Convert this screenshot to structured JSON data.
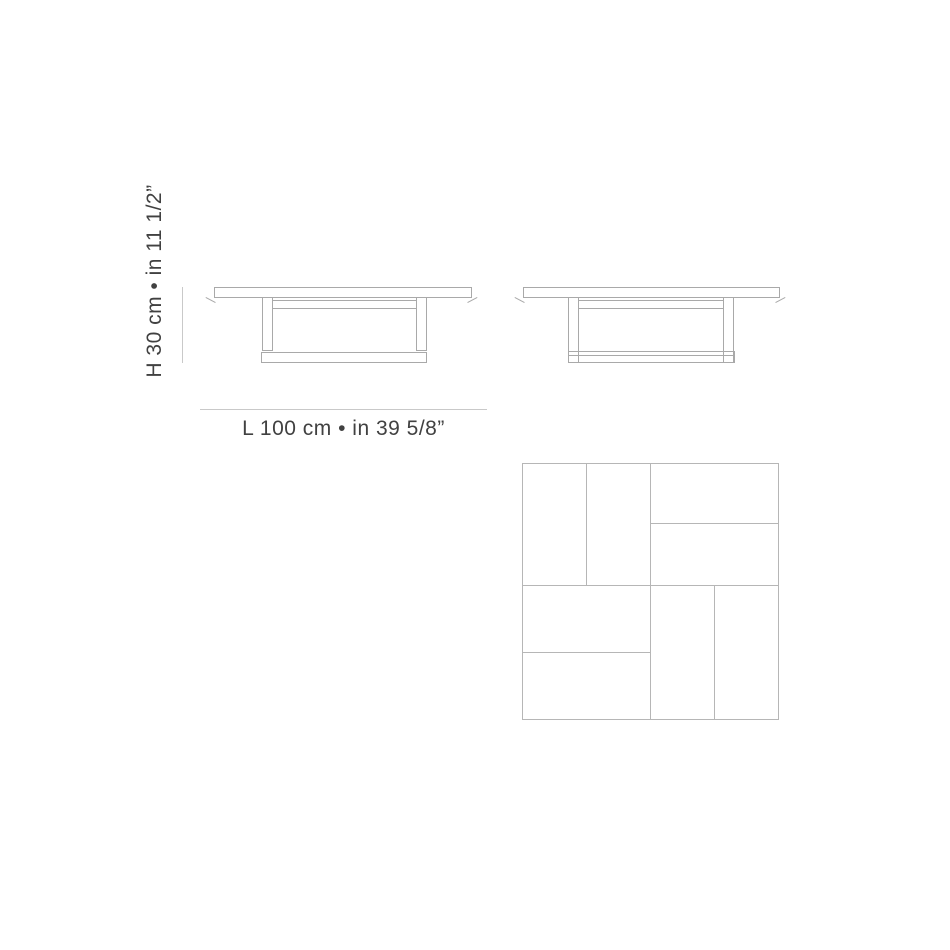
{
  "page": {
    "background": "#ffffff",
    "description_labels": {
      "height_label": "H 30 cm • in 11 1/2”",
      "length_label": "L 100 cm • in 39 5/8”"
    }
  },
  "dimensions": {
    "height_label": "H 30 cm • in 11 1/2”",
    "length_label": "L 100 cm • in 39 5/8”",
    "height_cm": "30",
    "height_in": "11 1/2",
    "length_cm": "100",
    "length_in": "39 5/8"
  },
  "views": {
    "front_elevation": "coffee-table-front-elevation",
    "side_elevation": "coffee-table-side-elevation",
    "top_plan": "coffee-table-top-plan-parquet"
  },
  "colors": {
    "page_background": "#ffffff",
    "drawing_line": "#a9a9a9",
    "parquet_line": "#b6b6b6",
    "dimension_line": "#c9c9c9",
    "text": "#414141"
  }
}
